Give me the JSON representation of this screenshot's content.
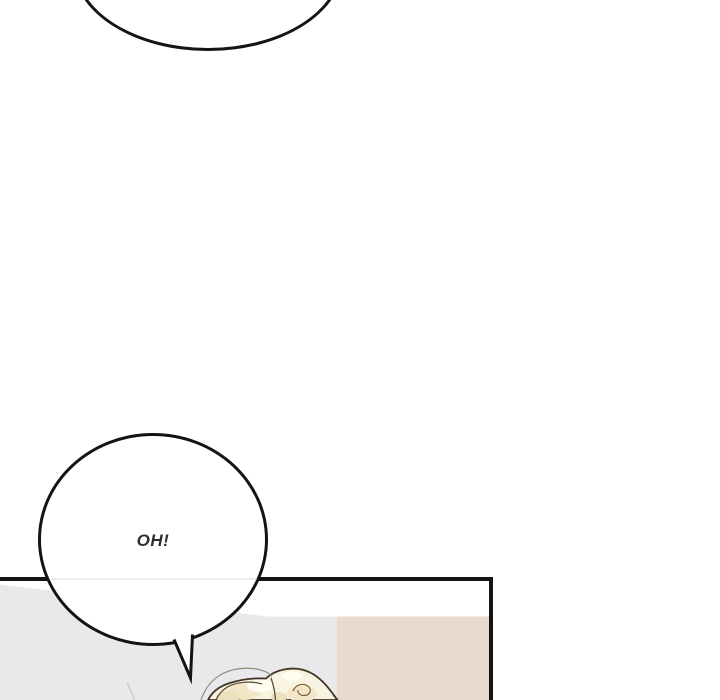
{
  "page": {
    "background": "#ffffff"
  },
  "bubbles": {
    "top_partial": {
      "text": "",
      "fill": "#ffffff",
      "outline": "#141414"
    },
    "oh": {
      "text": "OH!",
      "text_color": "#2d2d2d",
      "fill": "#ffffff",
      "outline": "#141414"
    }
  },
  "panel": {
    "outline": "#141414",
    "colors": {
      "wall_white": "#ffffff",
      "wall_gray": "#e9e9ec",
      "wall_beige": "#e8dbce",
      "wall_line": "#c9c9ce"
    },
    "hair": {
      "fill": "#f9f3e2",
      "outline": "#3e3325",
      "outline_warm": "#7a5527",
      "strand": "#95897a",
      "detail": "#5d4d38",
      "shadow": "#f2e7c9",
      "shadow_deep": "#ece0bd",
      "highlight": "#fffdf2"
    }
  }
}
